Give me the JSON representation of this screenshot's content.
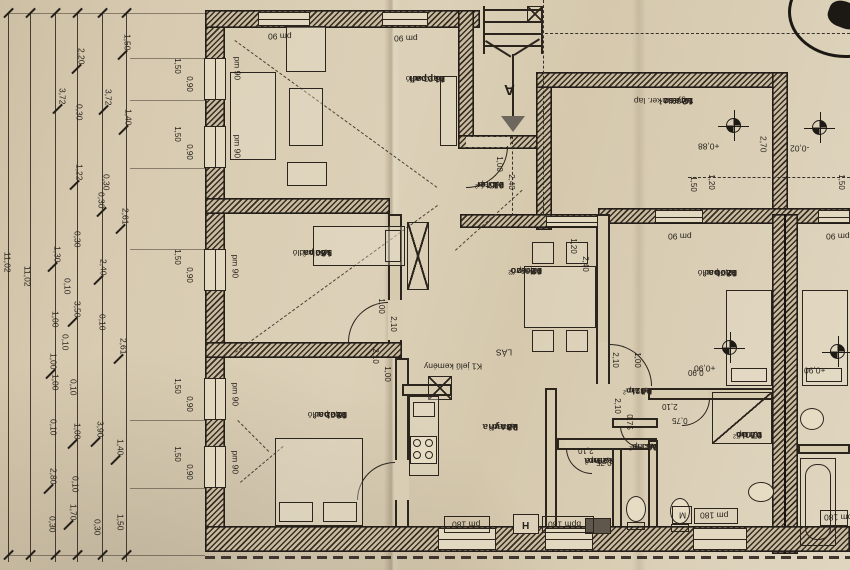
{
  "rooms": {
    "eloter": {
      "id": "01",
      "name": "előtér",
      "area": "2,47 m²",
      "floor": "ker.lap"
    },
    "etkezo": {
      "id": "02",
      "name": "étkező",
      "area": "13,89 m²",
      "floor": "ker.lap"
    },
    "konyha": {
      "id": "03",
      "name": "konyha",
      "area": "7,84 m²",
      "floor": "ker.lap"
    },
    "kozl": {
      "id": "04",
      "name": "közl.",
      "area": "2,45 m²",
      "floor": "ker.lap"
    },
    "kamra": {
      "name": "kamra",
      "area": "2,29 m²",
      "floor": "ker.lap"
    },
    "wc": {
      "id": "06",
      "name": "wc",
      "area": "1,53 m²",
      "floor": "ker.lap"
    },
    "furdo": {
      "id": "07",
      "name": "fürdő",
      "area": "7,00 m²",
      "floor": "ker.lap"
    },
    "szoba08": {
      "id": "08",
      "name": "szoba",
      "area": "12,70 m²",
      "floor": "lam. padló"
    },
    "szoba09": {
      "id": "09",
      "name": "szoba",
      "area": "15,22 m²",
      "floor": "lam. padló"
    },
    "szoba10": {
      "id": "10",
      "name": "szoba",
      "area": "9,52 m²",
      "floor": "lam. padló"
    },
    "nappali": {
      "id": "11",
      "name": "nappali",
      "area": "18,23 m²",
      "floor": "lam. padló"
    },
    "terasz": {
      "id": "12",
      "name": "terasz",
      "area": "15,89 m²",
      "floor": "fagyálló ker. lap"
    },
    "mirror_furdo": {
      "id": "07",
      "name": "fürdő",
      "area": "7,00 m²",
      "floor": "ker.lap"
    },
    "mirror_szoba": {
      "name": "szoba",
      "area": "m²",
      "floor": "lam. padló"
    }
  },
  "openings": {
    "pm90": "pm 90",
    "pm180": "pm 180",
    "bpm180": "bpm 180",
    "pm180m": "pm 180",
    "m": "M",
    "w150": "1,50",
    "h090": "0,90",
    "d100": "1,00",
    "d240": "2,40",
    "d120": "1,20",
    "d210": "2,10",
    "d075": "0,75",
    "d090": "0,90"
  },
  "levels": {
    "terasz_in": "+0,88",
    "terasz_out": "-0,02",
    "szoba08": "+0,90",
    "mirror": "+0,90"
  },
  "site": {
    "total_a": "11,02",
    "total_b": "11,02",
    "d270": "2,70",
    "d120": "1,20",
    "d150a": "1,50",
    "d150b": "1,50",
    "chain": [
      "1,50",
      "2,20",
      "3,72",
      "0,30",
      "3,72",
      "1,40",
      "1,22",
      "0,30",
      "0,30",
      "2,61",
      "0,30",
      "1,30",
      "2,40",
      "0,10",
      "3,50",
      "1,00",
      "0,10",
      "0,10",
      "2,61",
      "1,00",
      "1,00",
      "0,10",
      "0,10",
      "1,00",
      "3,90",
      "1,40",
      "2,80",
      "0,10",
      "1,70",
      "0,30",
      "0,30",
      "1,50"
    ]
  },
  "annotations": {
    "section": "A",
    "flue": "H",
    "chimney_note1": "K1 jelű kemény",
    "chimney_note2": "LÁS"
  }
}
